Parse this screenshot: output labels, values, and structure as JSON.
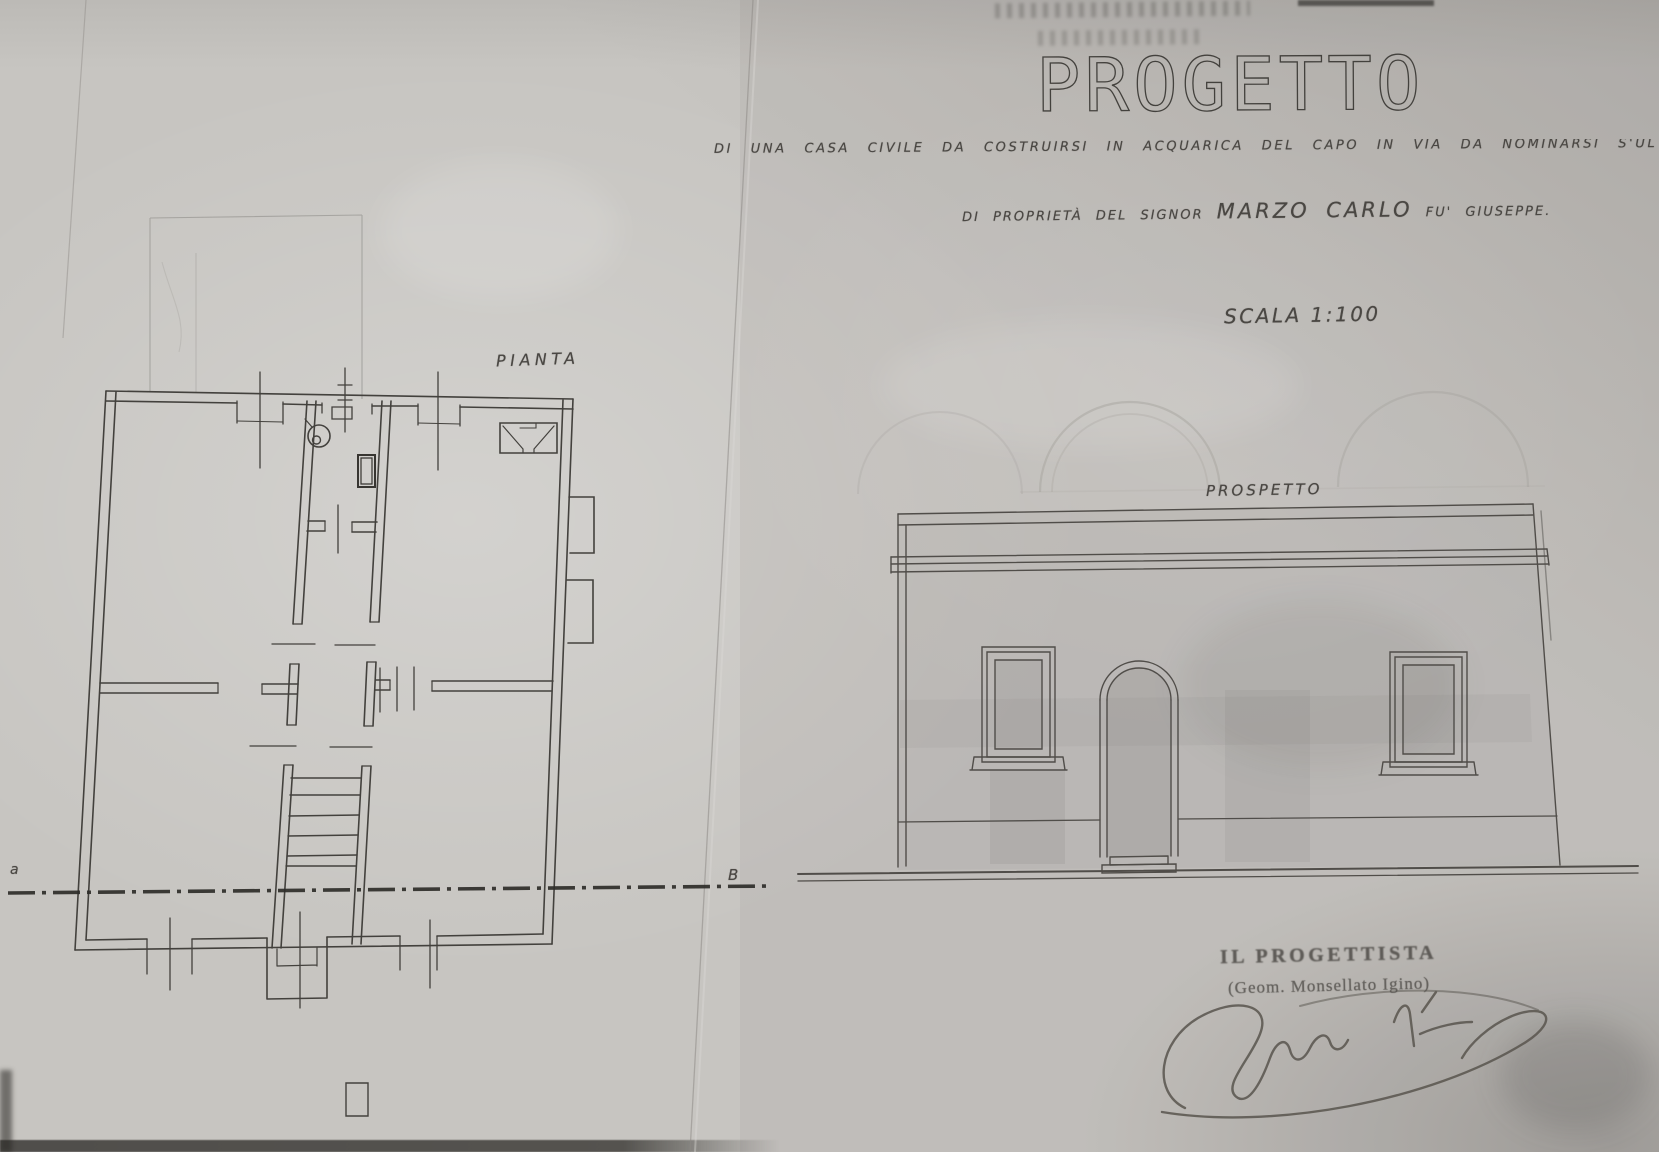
{
  "document": {
    "title": "PROGETTO",
    "subtitle_line": "DI UNA CASA CIVILE DA COSTRUIRSI IN ACQUARICA DEL CAPO IN VIA DA NOMINARSI S'UL S",
    "ownership_prefix": "DI PROPRIETÀ DEL SIGNOR",
    "owner_name": "MARZO CARLO",
    "ownership_suffix": "FU' GIUSEPPE.",
    "scale_label": "SCALA 1:100",
    "plan_label": "PIANTA",
    "elevation_label": "PROSPETTO",
    "designer_heading": "IL PROGETTISTA",
    "designer_name": "(Geom. Monsellato Igino)",
    "section_marker_left": "a",
    "section_marker_right": "B"
  },
  "colors": {
    "paper": "#c7c5c1",
    "ink": "#43413d",
    "soft_ink": "#4f4c48",
    "pencil": "#9a9894",
    "ghost": "#a5a29d"
  }
}
